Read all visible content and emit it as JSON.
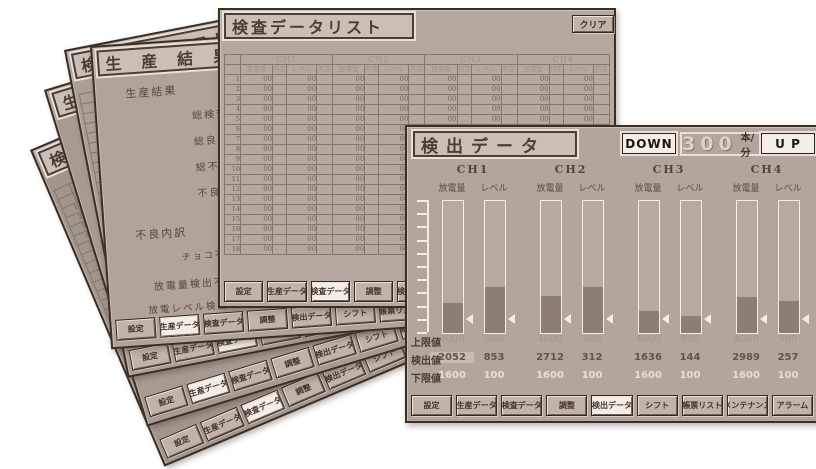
{
  "palette": {
    "page_bg": "#ffffff",
    "window_bg_front": "#b2a59d",
    "window_bg_list": "#b5a8a0",
    "window_bg_back": "#a2958e",
    "border_dark": "#3a2f27",
    "bar_fill": "#8c7d75",
    "bar_outline": "#f3ece4",
    "button_face": "#c0b3ab",
    "button_active": "#f2ede7",
    "text_dark": "#4c3e33",
    "rate_text": "#dcd1c7"
  },
  "nav_buttons": [
    "設定",
    "生産データ",
    "検査データ",
    "調整",
    "検出データ",
    "シフト",
    "帳票リスト",
    "メンテナンス",
    "アラーム"
  ],
  "stack_order": [
    "inspection-list",
    "production-result",
    "inspection-list",
    "production-result",
    "inspection-list",
    "detect-data"
  ],
  "windows": {
    "detect": {
      "title": "検出データ",
      "controls": {
        "down": "DOWN",
        "up": "U P",
        "rate_value": "300",
        "rate_unit": "本/分"
      },
      "column_headers": {
        "discharge": "放電量",
        "level": "レベル"
      },
      "row_labels": {
        "upper": "上限値",
        "detect": "検出値",
        "lower": "下限値"
      },
      "active_button": 4,
      "channels": [
        {
          "label": "CH1",
          "bars": [
            {
              "type": "discharge",
              "fill_pct": 23,
              "marker_pct": 10,
              "upper": "4000",
              "detect": "2052",
              "lower": "1600",
              "detect_highlight": true
            },
            {
              "type": "level",
              "fill_pct": 35,
              "marker_pct": 10,
              "upper": "900",
              "detect": "853",
              "lower": "100"
            }
          ]
        },
        {
          "label": "CH2",
          "bars": [
            {
              "type": "discharge",
              "fill_pct": 28,
              "marker_pct": 10,
              "upper": "4000",
              "detect": "2712",
              "lower": "1600"
            },
            {
              "type": "level",
              "fill_pct": 35,
              "marker_pct": 10,
              "upper": "900",
              "detect": "312",
              "lower": "100"
            }
          ]
        },
        {
          "label": "CH3",
          "bars": [
            {
              "type": "discharge",
              "fill_pct": 17,
              "marker_pct": 10,
              "upper": "4000",
              "detect": "1636",
              "lower": "1600"
            },
            {
              "type": "level",
              "fill_pct": 13,
              "marker_pct": 10,
              "upper": "900",
              "detect": "144",
              "lower": "100"
            }
          ]
        },
        {
          "label": "CH4",
          "bars": [
            {
              "type": "discharge",
              "fill_pct": 27,
              "marker_pct": 10,
              "upper": "4000",
              "detect": "2989",
              "lower": "1600"
            },
            {
              "type": "level",
              "fill_pct": 24,
              "marker_pct": 10,
              "upper": "900",
              "detect": "257",
              "lower": "100"
            }
          ]
        }
      ]
    },
    "list": {
      "title": "検査データリスト",
      "clear_label": "クリア",
      "channel_headers": [
        "CH1",
        "CH2",
        "CH3",
        "CH4"
      ],
      "sub_headers": [
        "放電量",
        "判定",
        "レベル",
        "判定"
      ],
      "row_count": 18,
      "cell_value": "00",
      "active_button": 2
    },
    "production": {
      "title": "生産結果",
      "lines": [
        "生産結果",
        "総検査数",
        "総良品数",
        "総不良数",
        "不良率",
        "不良内訳",
        "チョコ不良",
        "放電量検出不良品",
        "放電レベル検査不良品"
      ],
      "active_button": 1
    }
  }
}
